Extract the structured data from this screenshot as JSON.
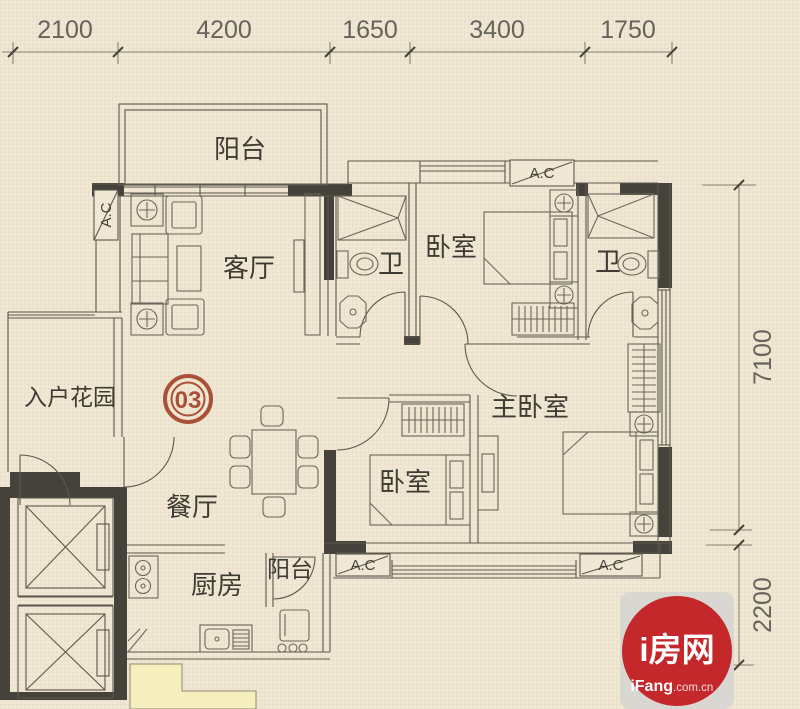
{
  "dimensions": {
    "top": [
      "2100",
      "4200",
      "1650",
      "3400",
      "1750"
    ],
    "right": [
      "7100",
      "2200"
    ]
  },
  "rooms": {
    "balcony_top": "阳台",
    "living_room": "客厅",
    "bathroom_1": "卫",
    "bedroom_1": "卧室",
    "bathroom_2": "卫",
    "master_bedroom": "主卧室",
    "entry_garden": "入户花园",
    "dining_room": "餐厅",
    "kitchen": "厨房",
    "balcony_bottom": "阳台",
    "bedroom_2": "卧室"
  },
  "unit_badge": "03",
  "ac_unit_label": "A.C",
  "logo": {
    "name": "i房网",
    "domain_bold": "iFang",
    "domain_suffix": ".com.cn"
  },
  "colors": {
    "paper": "#f0e8d5",
    "wall": "#44423a",
    "line": "#5c584c",
    "badge_red": "#aa4f38",
    "logo_red": "#c4282b",
    "logo_bg": "#d9d7d2",
    "adjacent_unit_fill": "#f6efbd"
  }
}
